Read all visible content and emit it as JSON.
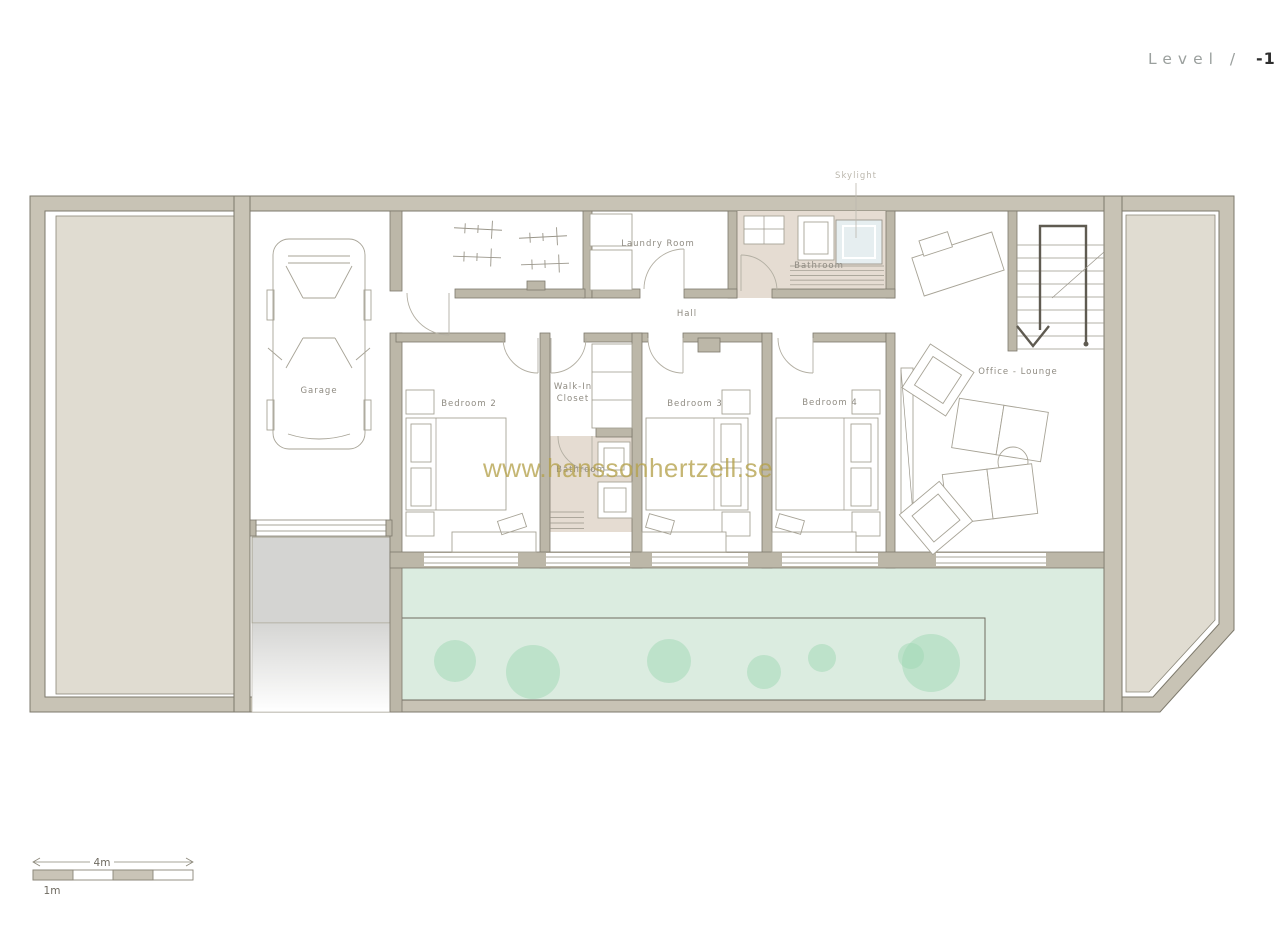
{
  "header": {
    "level_label": "Level /",
    "level_number": "-1"
  },
  "watermark": {
    "text": "www.hanssonhertzell.se",
    "color": "#b5a24b"
  },
  "rooms": {
    "garage": "Garage",
    "laundry_room": "Laundry Room",
    "bathroom_top": "Bathroom",
    "hall": "Hall",
    "skylight": "Skylight",
    "bedroom_2": "Bedroom 2",
    "walk_in_closet_line1": "Walk-In",
    "walk_in_closet_line2": "Closet",
    "bathroom_ensuite": "Bathroom",
    "bedroom_3": "Bedroom 3",
    "bedroom_4": "Bedroom 4",
    "office_lounge": "Office - Lounge"
  },
  "scale_bar": {
    "major_label": "4m",
    "minor_label": "1m"
  },
  "colors": {
    "wall_fill": "#c8c3b5",
    "interior_wall_fill": "#bcb7a8",
    "terrain_fill": "#e0dcd1",
    "bathroom_floor": "#e5dcd2",
    "terrace_green": "#dbece0",
    "bush_green": "#9fd8b4",
    "skylight_blue": "#e6eef0",
    "driveway_gray": "#d4d4d2",
    "watermark_gold": "#b5a24b"
  }
}
